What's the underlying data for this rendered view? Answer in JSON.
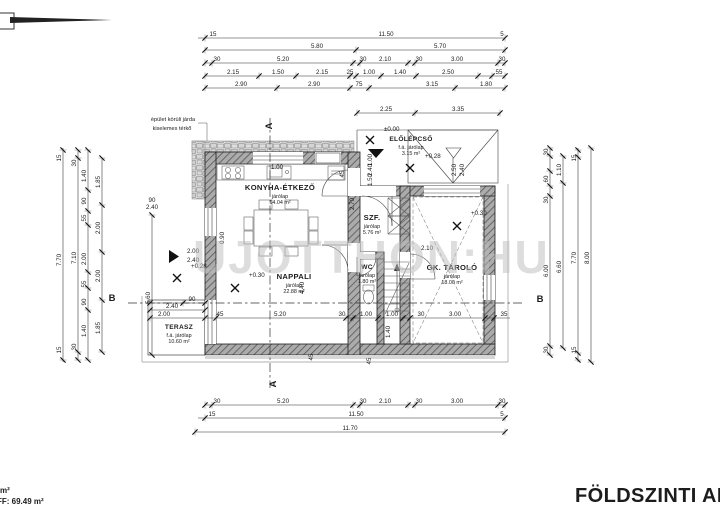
{
  "meta": {
    "title": "FÖLDSZINTI AL",
    "watermark": "UJOTTHON:HU",
    "corner_note": {
      "line1": "m²",
      "line2": "FF: 69.49 m²"
    },
    "walkway_note": {
      "line1": "épület körüli járda",
      "line2": "kiselemes térkő"
    }
  },
  "rooms": [
    {
      "name": "KONYHA-ÉTKEZŐ",
      "sub1": "járólap",
      "sub2": "14.04 m²",
      "x": 280,
      "y": 190,
      "small": false
    },
    {
      "name": "NAPPALI",
      "sub1": "járólap",
      "sub2": "22.88 m²",
      "x": 294,
      "y": 279,
      "small": false
    },
    {
      "name": "TERASZ",
      "sub1": "f.á. járólap",
      "sub2": "10.60 m²",
      "x": 179,
      "y": 329,
      "small": true
    },
    {
      "name": "SZF.",
      "sub1": "járólap",
      "sub2": "5.76 m²",
      "x": 372,
      "y": 220,
      "small": false
    },
    {
      "name": "WC",
      "sub1": "járólap",
      "sub2": "1.80 m²",
      "x": 367,
      "y": 269,
      "small": true
    },
    {
      "name": "GK. TÁROLÓ",
      "sub1": "járólap",
      "sub2": "18.00 m²",
      "x": 452,
      "y": 270,
      "small": false
    },
    {
      "name": "ELŐLÉPCSŐ",
      "sub1": "f.á. járólap",
      "sub2": "3.15 m²",
      "x": 411,
      "y": 141,
      "small": true
    }
  ],
  "levels": [
    {
      "label": "±0.00",
      "tx": 384,
      "ty": 131,
      "mx": 370,
      "my": 140
    },
    {
      "label": "+0.28",
      "tx": 425,
      "ty": 158,
      "mx": 410,
      "my": 168
    },
    {
      "label": "+0.28",
      "tx": 191,
      "ty": 268,
      "mx": 177,
      "my": 278
    },
    {
      "label": "+0.30",
      "tx": 249,
      "ty": 277,
      "mx": 235,
      "my": 288
    },
    {
      "label": "+0.30",
      "tx": 471,
      "ty": 215,
      "mx": 457,
      "my": 226
    }
  ],
  "sections": [
    {
      "label": "A",
      "x": 272,
      "y": 126,
      "rot": -90
    },
    {
      "label": "A",
      "x": 276,
      "y": 384,
      "rot": -90
    },
    {
      "label": "B",
      "x": 112,
      "y": 301,
      "rot": 0
    },
    {
      "label": "B",
      "x": 540,
      "y": 302,
      "rot": 0
    }
  ],
  "chains": [
    {
      "o": "h",
      "c": 38,
      "a": 198,
      "b": 505,
      "ticks": [
        205,
        505
      ],
      "labels": [
        {
          "t": "15",
          "p": 213
        },
        {
          "t": "11.50",
          "p": 386
        },
        {
          "t": "5",
          "p": 502
        }
      ]
    },
    {
      "o": "h",
      "c": 50,
      "a": 205,
      "b": 505,
      "ticks": [
        205,
        356,
        505
      ],
      "labels": [
        {
          "t": "5.80",
          "p": 317
        },
        {
          "t": "5.70",
          "p": 440
        }
      ]
    },
    {
      "o": "h",
      "c": 63,
      "a": 205,
      "b": 505,
      "ticks": [
        205,
        212,
        353,
        360,
        408,
        415,
        498,
        505
      ],
      "labels": [
        {
          "t": "30",
          "p": 217
        },
        {
          "t": "5.20",
          "p": 283
        },
        {
          "t": "30",
          "p": 363
        },
        {
          "t": "2.10",
          "p": 385
        },
        {
          "t": "30",
          "p": 419
        },
        {
          "t": "3.00",
          "p": 457
        },
        {
          "t": "30",
          "p": 502
        }
      ]
    },
    {
      "o": "h",
      "c": 76,
      "a": 205,
      "b": 505,
      "ticks": [
        205,
        259,
        296,
        350,
        356,
        381,
        416,
        478,
        492,
        505
      ],
      "labels": [
        {
          "t": "2.15",
          "p": 233
        },
        {
          "t": "1.50",
          "p": 278
        },
        {
          "t": "2.15",
          "p": 322
        },
        {
          "t": "25",
          "p": 350
        },
        {
          "t": "1.00",
          "p": 369
        },
        {
          "t": "1.40",
          "p": 400
        },
        {
          "t": "2.50",
          "p": 448
        },
        {
          "t": "55",
          "p": 499
        }
      ]
    },
    {
      "o": "h",
      "c": 88,
      "a": 205,
      "b": 505,
      "ticks": [
        205,
        277,
        350,
        369,
        455,
        505
      ],
      "labels": [
        {
          "t": "2.90",
          "p": 241
        },
        {
          "t": "2.90",
          "p": 314
        },
        {
          "t": "75",
          "p": 359
        },
        {
          "t": "3.15",
          "p": 432
        },
        {
          "t": "1.80",
          "p": 486
        }
      ]
    },
    {
      "o": "h",
      "c": 113,
      "a": 357,
      "b": 500,
      "ticks": [
        357,
        415,
        500
      ],
      "labels": [
        {
          "t": "2.25",
          "p": 386
        },
        {
          "t": "3.35",
          "p": 458
        }
      ]
    },
    {
      "o": "h",
      "c": 405,
      "a": 205,
      "b": 505,
      "ticks": [
        205,
        212,
        353,
        360,
        408,
        415,
        498,
        505
      ],
      "labels": [
        {
          "t": "30",
          "p": 217
        },
        {
          "t": "5.20",
          "p": 283
        },
        {
          "t": "30",
          "p": 363
        },
        {
          "t": "2.10",
          "p": 385
        },
        {
          "t": "30",
          "p": 419
        },
        {
          "t": "3.00",
          "p": 457
        },
        {
          "t": "30",
          "p": 502
        }
      ]
    },
    {
      "o": "h",
      "c": 418,
      "a": 198,
      "b": 505,
      "ticks": [
        205,
        505
      ],
      "labels": [
        {
          "t": "15",
          "p": 212
        },
        {
          "t": "11.50",
          "p": 356
        },
        {
          "t": "5",
          "p": 502
        }
      ]
    },
    {
      "o": "h",
      "c": 432,
      "a": 195,
      "b": 505,
      "ticks": [
        195,
        505
      ],
      "labels": [
        {
          "t": "11.70",
          "p": 350
        }
      ]
    },
    {
      "o": "h",
      "c": 318,
      "a": 150,
      "b": 510,
      "ticks": [
        150,
        205,
        216,
        346,
        353,
        378,
        403,
        410,
        485,
        494
      ],
      "labels": [
        {
          "t": "2.00",
          "p": 164
        },
        {
          "t": "45",
          "p": 220
        },
        {
          "t": "5.20",
          "p": 280
        },
        {
          "t": "30",
          "p": 342
        },
        {
          "t": "1.00",
          "p": 366
        },
        {
          "t": "1.00",
          "p": 392
        },
        {
          "t": "30",
          "p": 421
        },
        {
          "t": "3.00",
          "p": 455
        },
        {
          "t": "35",
          "p": 504
        }
      ]
    },
    {
      "o": "h",
      "c": 303,
      "a": 150,
      "b": 205,
      "ticks": [
        150,
        183,
        205
      ],
      "labels": [
        {
          "t": "90",
          "p": 192
        }
      ]
    },
    {
      "o": "h",
      "c": 310,
      "a": 150,
      "b": 205,
      "ticks": [
        150,
        205
      ],
      "labels": [
        {
          "t": "2.40",
          "p": 172
        }
      ]
    },
    {
      "o": "v",
      "c": 63,
      "a": 148,
      "b": 362,
      "ticks": [
        150,
        360
      ],
      "labels": [
        {
          "t": "15",
          "p": 158
        },
        {
          "t": "7.70",
          "p": 260
        },
        {
          "t": "15",
          "p": 350
        }
      ]
    },
    {
      "o": "v",
      "c": 78,
      "a": 150,
      "b": 360,
      "ticks": [
        150,
        158,
        352,
        360
      ],
      "labels": [
        {
          "t": "30",
          "p": 163
        },
        {
          "t": "7.10",
          "p": 258
        },
        {
          "t": "30",
          "p": 347
        }
      ]
    },
    {
      "o": "v",
      "c": 88,
      "a": 150,
      "b": 360,
      "ticks": [
        150,
        190,
        211,
        225,
        272,
        288,
        310,
        360
      ],
      "labels": [
        {
          "t": "1.40",
          "p": 176
        },
        {
          "t": "90",
          "p": 201
        },
        {
          "t": "55",
          "p": 218
        },
        {
          "t": "2.00",
          "p": 259
        },
        {
          "t": "55",
          "p": 284
        },
        {
          "t": "90",
          "p": 302
        },
        {
          "t": "1.40",
          "p": 331
        }
      ]
    },
    {
      "o": "v",
      "c": 102,
      "a": 158,
      "b": 352,
      "ticks": [
        158,
        205,
        252,
        300,
        352
      ],
      "labels": [
        {
          "t": "1.85",
          "p": 182
        },
        {
          "t": "2.00",
          "p": 228
        },
        {
          "t": "2.00",
          "p": 276
        },
        {
          "t": "1.85",
          "p": 328
        }
      ]
    },
    {
      "o": "v",
      "c": 152,
      "a": 215,
      "b": 355,
      "ticks": [
        215,
        355
      ],
      "labels": [
        {
          "t": "5.60",
          "p": 298
        }
      ]
    },
    {
      "o": "v",
      "c": 550,
      "a": 148,
      "b": 355,
      "ticks": [
        148,
        156,
        171,
        186,
        196,
        346,
        355
      ],
      "labels": [
        {
          "t": "30",
          "p": 152
        },
        {
          "t": "60",
          "p": 179
        },
        {
          "t": "30",
          "p": 200
        },
        {
          "t": "6.00",
          "p": 271
        },
        {
          "t": "30",
          "p": 350
        }
      ]
    },
    {
      "o": "v",
      "c": 563,
      "a": 156,
      "b": 348,
      "ticks": [
        156,
        183,
        348
      ],
      "labels": [
        {
          "t": "1.10",
          "p": 170
        },
        {
          "t": "6.60",
          "p": 267
        }
      ]
    },
    {
      "o": "v",
      "c": 578,
      "a": 148,
      "b": 362,
      "ticks": [
        150,
        157,
        353,
        360
      ],
      "labels": [
        {
          "t": "15",
          "p": 158
        },
        {
          "t": "7.70",
          "p": 258
        },
        {
          "t": "15",
          "p": 350
        }
      ]
    },
    {
      "o": "v",
      "c": 591,
      "a": 148,
      "b": 362,
      "ticks": [
        148,
        362
      ],
      "labels": [
        {
          "t": "8.00",
          "p": 258
        }
      ]
    }
  ],
  "floats": [
    {
      "t": "1.00",
      "x": 277,
      "y": 169,
      "r": 0
    },
    {
      "t": "45",
      "x": 344,
      "y": 174,
      "r": -90
    },
    {
      "t": "2.70",
      "x": 354,
      "y": 204,
      "r": -90
    },
    {
      "t": "0.90",
      "x": 224,
      "y": 238,
      "r": -90
    },
    {
      "t": "90",
      "x": 152,
      "y": 202,
      "r": 0
    },
    {
      "t": "2.40",
      "x": 152,
      "y": 209,
      "r": 0
    },
    {
      "t": "2.00",
      "x": 193,
      "y": 253,
      "r": 0
    },
    {
      "t": "2.40",
      "x": 193,
      "y": 262,
      "r": 0
    },
    {
      "t": "2.10",
      "x": 427,
      "y": 250,
      "r": 0
    },
    {
      "t": "1.40",
      "x": 390,
      "y": 332,
      "r": -90
    },
    {
      "t": "45",
      "x": 371,
      "y": 361,
      "r": -90
    },
    {
      "t": "45",
      "x": 313,
      "y": 357,
      "r": -90
    },
    {
      "t": "4.40",
      "x": 304,
      "y": 288,
      "r": -90
    },
    {
      "t": "1.00",
      "x": 372,
      "y": 160,
      "r": -90
    },
    {
      "t": "2.40",
      "x": 372,
      "y": 170,
      "r": -90
    },
    {
      "t": "1.50",
      "x": 372,
      "y": 180,
      "r": -90
    },
    {
      "t": "2.50",
      "x": 456,
      "y": 170,
      "r": -90
    },
    {
      "t": "2.40",
      "x": 464,
      "y": 170,
      "r": -90
    }
  ]
}
